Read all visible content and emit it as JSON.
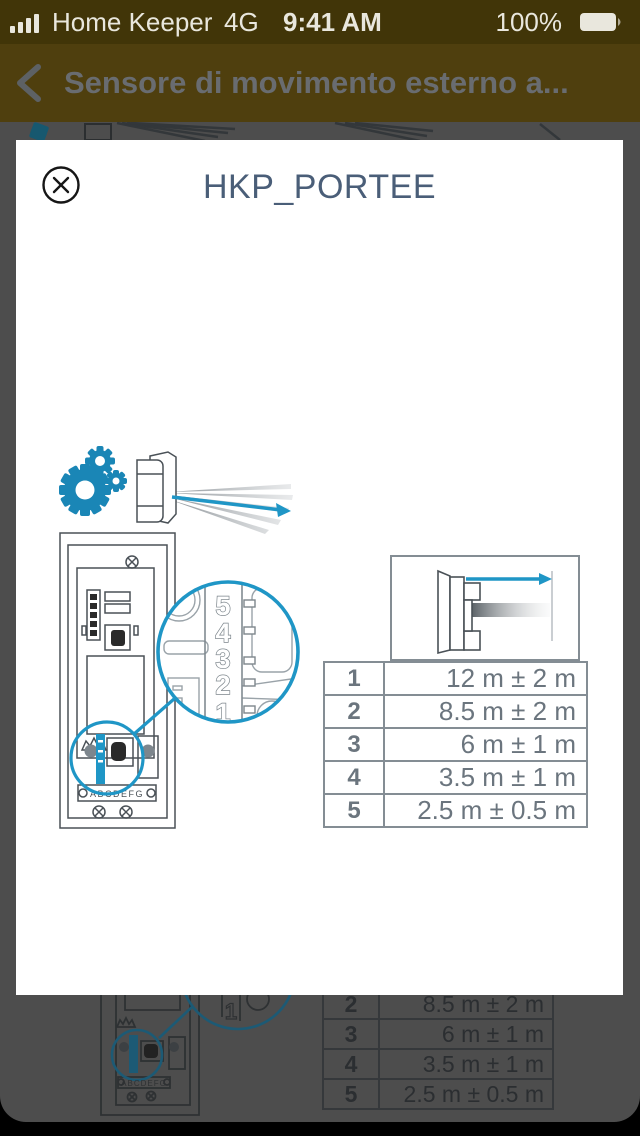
{
  "status_bar": {
    "carrier": "Home Keeper",
    "network": "4G",
    "time": "9:41 AM",
    "battery_percent": "100%"
  },
  "nav_bar": {
    "title": "Sensore di movimento esterno a..."
  },
  "modal": {
    "title": "HKP_PORTEE",
    "close_icon": "circle-x-icon",
    "diagram": {
      "dial_numbers": [
        "5",
        "4",
        "3",
        "2",
        "1"
      ],
      "terminal_labels": "ABCDEFG"
    },
    "range_table": {
      "rows": [
        {
          "position": "1",
          "range": "12 m ± 2 m"
        },
        {
          "position": "2",
          "range": "8.5 m ± 2 m"
        },
        {
          "position": "3",
          "range": "6 m ± 1 m"
        },
        {
          "position": "4",
          "range": "3.5 m ± 1 m"
        },
        {
          "position": "5",
          "range": "2.5 m ± 0.5 m"
        }
      ]
    }
  },
  "colors": {
    "accent_blue": "#1f96c6",
    "gear_blue": "#1a86b6",
    "dimmed_blue": "#1c5a75",
    "table_text_gray": "#6b757e",
    "table_border_gray": "#848d94",
    "statusbar_bg": "#413508",
    "navbar_bg": "#4f3f0e",
    "scrim_gray": "#4d4d4d"
  }
}
